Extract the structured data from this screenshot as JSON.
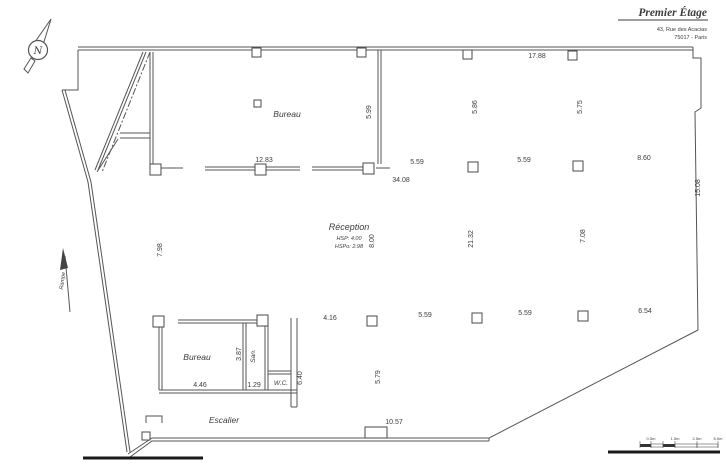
{
  "header": {
    "title": "Premier Étage",
    "address1": "43, Rue des Acacias",
    "address2": "75017 - Paris"
  },
  "north": {
    "letter": "N"
  },
  "rooms": {
    "bureau_top": "Bureau",
    "reception": "Réception",
    "reception_hsp": "HSP: 4.00",
    "reception_hspo": "HSPo: 2.98",
    "bureau_bottom": "Bureau",
    "san": "San.",
    "wc": "W.C.",
    "escalier": "Escalier",
    "rampe": "Rampe"
  },
  "dims": {
    "top_width": "17.88",
    "bureau_width": "12.83",
    "total_width": "34.08",
    "mid_bay_1": "5.59",
    "mid_bay_2": "5.59",
    "mid_bay_3": "8.60",
    "bot_bay_1": "4.16",
    "bot_bay_2": "5.59",
    "bot_bay_3": "5.59",
    "bot_bay_4": "6.54",
    "bureau_top_height": "5.99",
    "bay_height_1": "5.86",
    "bay_height_2": "5.75",
    "left_height": "7.98",
    "reception_width": "8.00",
    "reception_height": "21.32",
    "right_bay_height": "7.08",
    "right_height": "15.08",
    "bureau_bottom_width": "4.46",
    "san_width": "1.29",
    "bureau_bottom_height": "3.87",
    "shaft_height": "6.40",
    "bottom_bay_height": "5.79",
    "bottom_opening": "10.57"
  },
  "scale_bar": {
    "labels": [
      "0.5m",
      "1.5m",
      "2.5m",
      "5.0m"
    ]
  }
}
